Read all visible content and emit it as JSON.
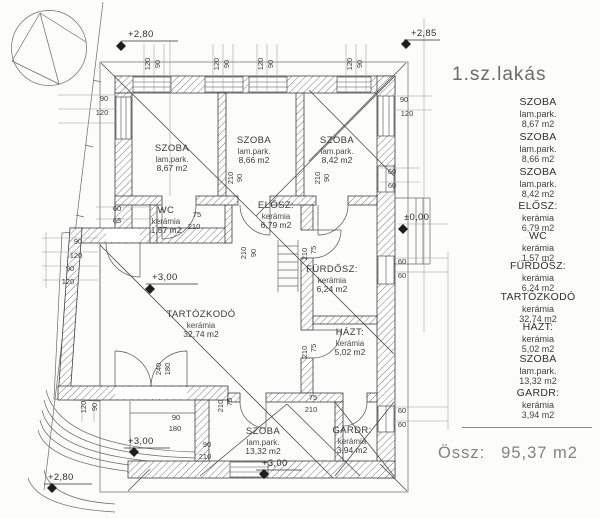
{
  "plan": {
    "title": "1.sz.lakás",
    "total_label": "Össz:",
    "total_value": "95,37 m2"
  },
  "rooms": {
    "szoba1": {
      "name": "SZOBA",
      "floor": "lam.park.",
      "area": "8,67 m2"
    },
    "szoba2": {
      "name": "SZOBA",
      "floor": "lam.park.",
      "area": "8,66 m2"
    },
    "szoba3": {
      "name": "SZOBA",
      "floor": "lam.park.",
      "area": "8,42 m2"
    },
    "elosz": {
      "name": "ELŐSZ:",
      "floor": "kerámia",
      "area": "6,79 m2"
    },
    "wc": {
      "name": "WC",
      "floor": "kerámia",
      "area": "1,57 m2"
    },
    "furdosz": {
      "name": "FÜRDŐSZ:",
      "floor": "kerámia",
      "area": "6,24 m2"
    },
    "tartozkodo": {
      "name": "TARTÓZKODÓ",
      "floor": "kerámia",
      "area": "32,74 m2"
    },
    "hazt": {
      "name": "HÁZT:",
      "floor": "kerámia",
      "area": "5,02 m2"
    },
    "szoba4": {
      "name": "SZOBA",
      "floor": "lam.park.",
      "area": "13,32 m2"
    },
    "gardr": {
      "name": "GARDR:",
      "floor": "kerámia",
      "area": "3,94 m2"
    }
  },
  "levels": {
    "top_left": "+2,80",
    "top_right": "+2,85",
    "entrance": "±0,00",
    "living": "+3,00",
    "terrace": "+3,00",
    "bedroom": "+3,00",
    "garden": "+2,80"
  },
  "dim": {
    "v60": "60",
    "v65": "65",
    "v75": "75",
    "v90": "90",
    "v120": "120",
    "v180": "180",
    "v210": "210",
    "v240": "240"
  },
  "colors": {
    "background": "#fcfcfb",
    "line": "#4a4a4a",
    "dim_text": "#3a3a3a",
    "muted_text": "#828282"
  }
}
